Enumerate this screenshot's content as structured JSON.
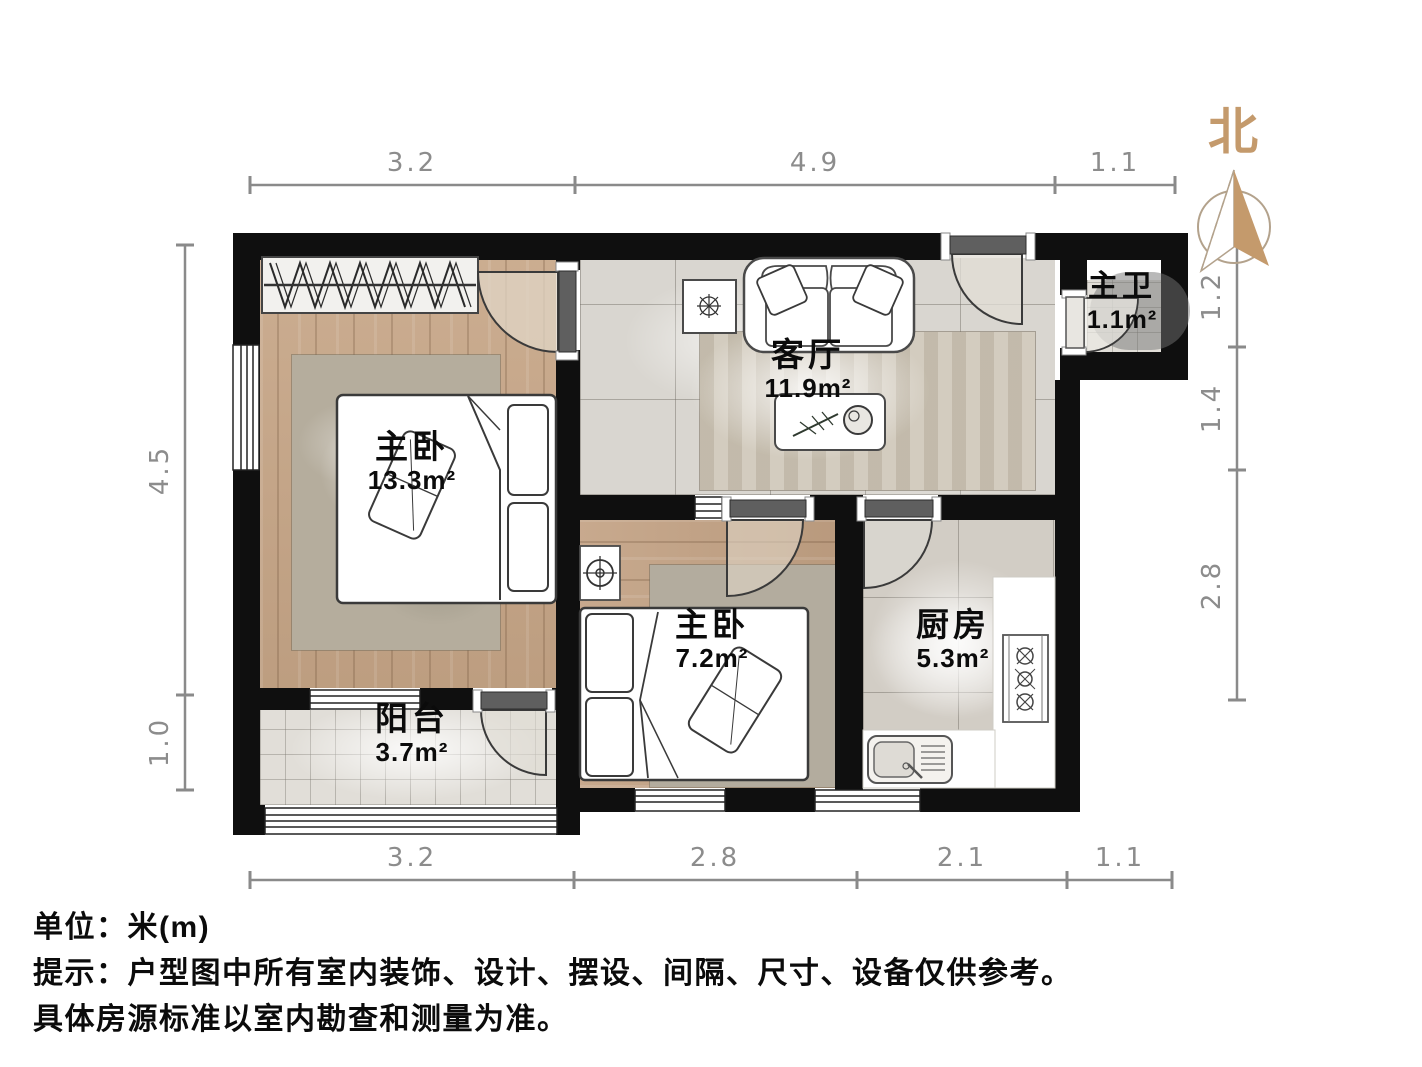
{
  "compass": {
    "label": "北"
  },
  "rooms": [
    {
      "id": "master-bedroom",
      "name": "主卧",
      "area": "13.3m²"
    },
    {
      "id": "living-room",
      "name": "客厅",
      "area": "11.9m²"
    },
    {
      "id": "master-bath",
      "name": "主卫",
      "area": "1.1m²"
    },
    {
      "id": "second-bedroom",
      "name": "主卧",
      "area": "7.2m²"
    },
    {
      "id": "kitchen",
      "name": "厨房",
      "area": "5.3m²"
    },
    {
      "id": "balcony",
      "name": "阳台",
      "area": "3.7m²"
    }
  ],
  "dimensions": {
    "top": [
      "3.2",
      "4.9",
      "1.1"
    ],
    "bottom": [
      "3.2",
      "2.8",
      "2.1",
      "1.1"
    ],
    "left": [
      "4.5",
      "1.0"
    ],
    "right": [
      "1.2",
      "1.4",
      "2.8"
    ]
  },
  "footer": {
    "unit": "单位：米(m)",
    "note1": "提示：户型图中所有室内装饰、设计、摆设、间隔、尺寸、设备仅供参考。",
    "note2": "具体房源标准以室内勘查和测量为准。"
  },
  "colors": {
    "accent": "#c49a6c",
    "wall": "#0f0f0f",
    "dim_line": "#8a8a8a"
  }
}
